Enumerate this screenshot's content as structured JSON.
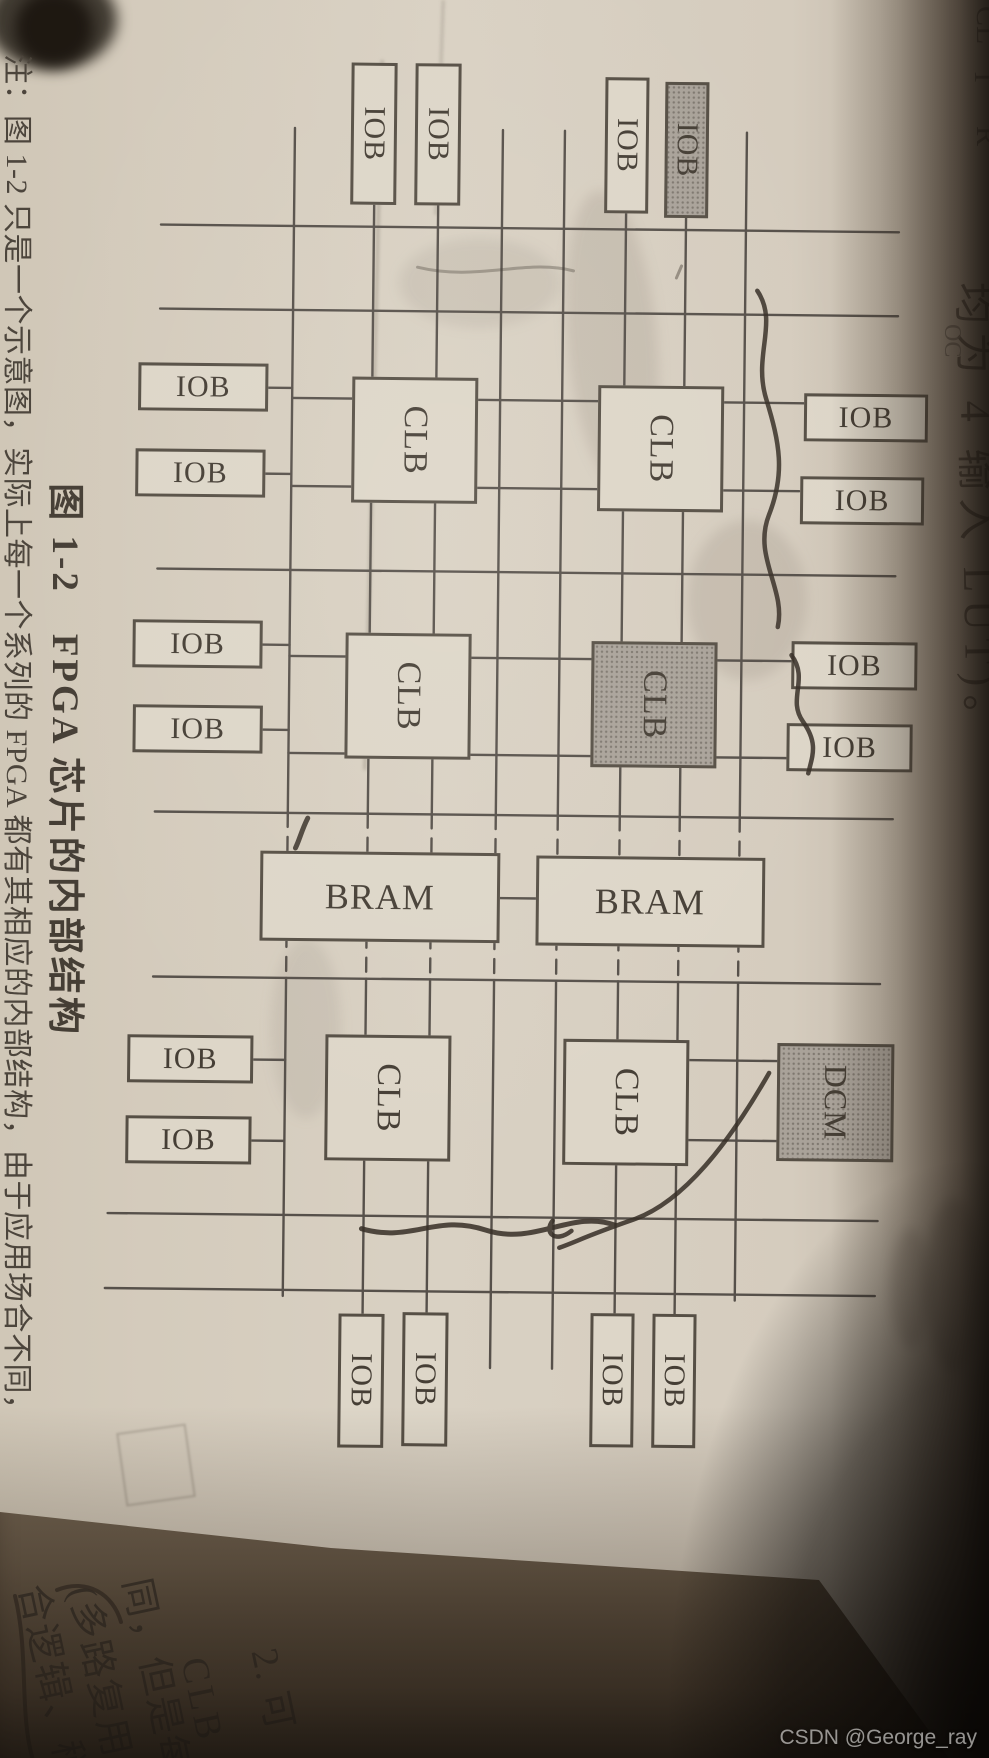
{
  "photo": {
    "watermark": "CSDN @George_ray"
  },
  "page": {
    "caption": "图 1-2　FPGA 芯片的内部结构",
    "note": "注：图 1-2 只是一个示意图，实际上每一个系列的 FPGA 都有其相应的内部结构，由于应用场合不同，",
    "top_fragments": {
      "lut": "均为 4 输入 LUT)。",
      "cl": "CL",
      "t": "T",
      "r": "R",
      "oc": "OC",
      "clk": "CLK"
    },
    "next_page": {
      "lines": [
        "2. 可",
        "CLB",
        "同，但是每",
        "(多路复用",
        "合逻辑、稍"
      ]
    }
  },
  "diagram": {
    "block_types": [
      "IOB",
      "CLB",
      "BRAM",
      "DCM"
    ],
    "shaded_color": "#a9a299",
    "box_color": "#ddd6c8",
    "line_color": "#56504a",
    "blocks": [
      {
        "label": "IOB",
        "x": 64,
        "y": 598,
        "w": 142,
        "h": 46,
        "fs": 30,
        "rot": false,
        "shaded": false
      },
      {
        "label": "IOB",
        "x": 64,
        "y": 534,
        "w": 142,
        "h": 46,
        "fs": 30,
        "rot": false,
        "shaded": false
      },
      {
        "label": "IOB",
        "x": 76,
        "y": 346,
        "w": 136,
        "h": 44,
        "fs": 30,
        "rot": false,
        "shaded": false
      },
      {
        "label": "IOB",
        "x": 80,
        "y": 286,
        "w": 136,
        "h": 44,
        "fs": 30,
        "rot": false,
        "shaded": true
      },
      {
        "label": "IOB",
        "x": 390,
        "y": 64,
        "w": 48,
        "h": 124,
        "fs": 30,
        "rot": true,
        "shaded": false
      },
      {
        "label": "IOB",
        "x": 473,
        "y": 67,
        "w": 48,
        "h": 124,
        "fs": 30,
        "rot": true,
        "shaded": false
      },
      {
        "label": "IOB",
        "x": 638,
        "y": 72,
        "w": 48,
        "h": 126,
        "fs": 30,
        "rot": true,
        "shaded": false
      },
      {
        "label": "IOB",
        "x": 720,
        "y": 76,
        "w": 48,
        "h": 126,
        "fs": 30,
        "rot": true,
        "shaded": false
      },
      {
        "label": "IOB",
        "x": 366,
        "y": 724,
        "w": 48,
        "h": 130,
        "fs": 30,
        "rot": true,
        "shaded": false
      },
      {
        "label": "IOB",
        "x": 452,
        "y": 726,
        "w": 48,
        "h": 130,
        "fs": 30,
        "rot": true,
        "shaded": false
      },
      {
        "label": "IOB",
        "x": 623,
        "y": 727,
        "w": 48,
        "h": 130,
        "fs": 30,
        "rot": true,
        "shaded": false
      },
      {
        "label": "IOB",
        "x": 708,
        "y": 726,
        "w": 48,
        "h": 130,
        "fs": 30,
        "rot": true,
        "shaded": false
      },
      {
        "label": "IOB",
        "x": 1038,
        "y": 732,
        "w": 48,
        "h": 126,
        "fs": 30,
        "rot": true,
        "shaded": false
      },
      {
        "label": "IOB",
        "x": 1119,
        "y": 733,
        "w": 48,
        "h": 126,
        "fs": 30,
        "rot": true,
        "shaded": false
      },
      {
        "label": "IOB",
        "x": 1315,
        "y": 598,
        "w": 134,
        "h": 46,
        "fs": 30,
        "rot": false,
        "shaded": false
      },
      {
        "label": "IOB",
        "x": 1313,
        "y": 534,
        "w": 134,
        "h": 46,
        "fs": 30,
        "rot": false,
        "shaded": false
      },
      {
        "label": "IOB",
        "x": 1312,
        "y": 348,
        "w": 134,
        "h": 44,
        "fs": 30,
        "rot": false,
        "shaded": false
      },
      {
        "label": "IOB",
        "x": 1312,
        "y": 286,
        "w": 134,
        "h": 44,
        "fs": 30,
        "rot": false,
        "shaded": false
      },
      {
        "label": "CLB",
        "x": 378,
        "y": 514,
        "w": 126,
        "h": 126,
        "fs": 34,
        "rot": false,
        "shaded": false
      },
      {
        "label": "CLB",
        "x": 384,
        "y": 268,
        "w": 126,
        "h": 126,
        "fs": 34,
        "rot": false,
        "shaded": false
      },
      {
        "label": "CLB",
        "x": 634,
        "y": 518,
        "w": 126,
        "h": 126,
        "fs": 34,
        "rot": false,
        "shaded": false
      },
      {
        "label": "CLB",
        "x": 640,
        "y": 272,
        "w": 126,
        "h": 126,
        "fs": 34,
        "rot": false,
        "shaded": true
      },
      {
        "label": "CLB",
        "x": 1036,
        "y": 534,
        "w": 126,
        "h": 126,
        "fs": 34,
        "rot": false,
        "shaded": false
      },
      {
        "label": "CLB",
        "x": 1038,
        "y": 296,
        "w": 126,
        "h": 126,
        "fs": 34,
        "rot": false,
        "shaded": false
      },
      {
        "label": "BRAM",
        "x": 853,
        "y": 487,
        "w": 90,
        "h": 240,
        "fs": 36,
        "rot": true,
        "shaded": false
      },
      {
        "label": "BRAM",
        "x": 855,
        "y": 222,
        "w": 90,
        "h": 229,
        "fs": 36,
        "rot": true,
        "shaded": false
      },
      {
        "label": "DCM",
        "x": 1040,
        "y": 91,
        "w": 118,
        "h": 117,
        "fs": 32,
        "rot": false,
        "shaded": true
      }
    ]
  }
}
